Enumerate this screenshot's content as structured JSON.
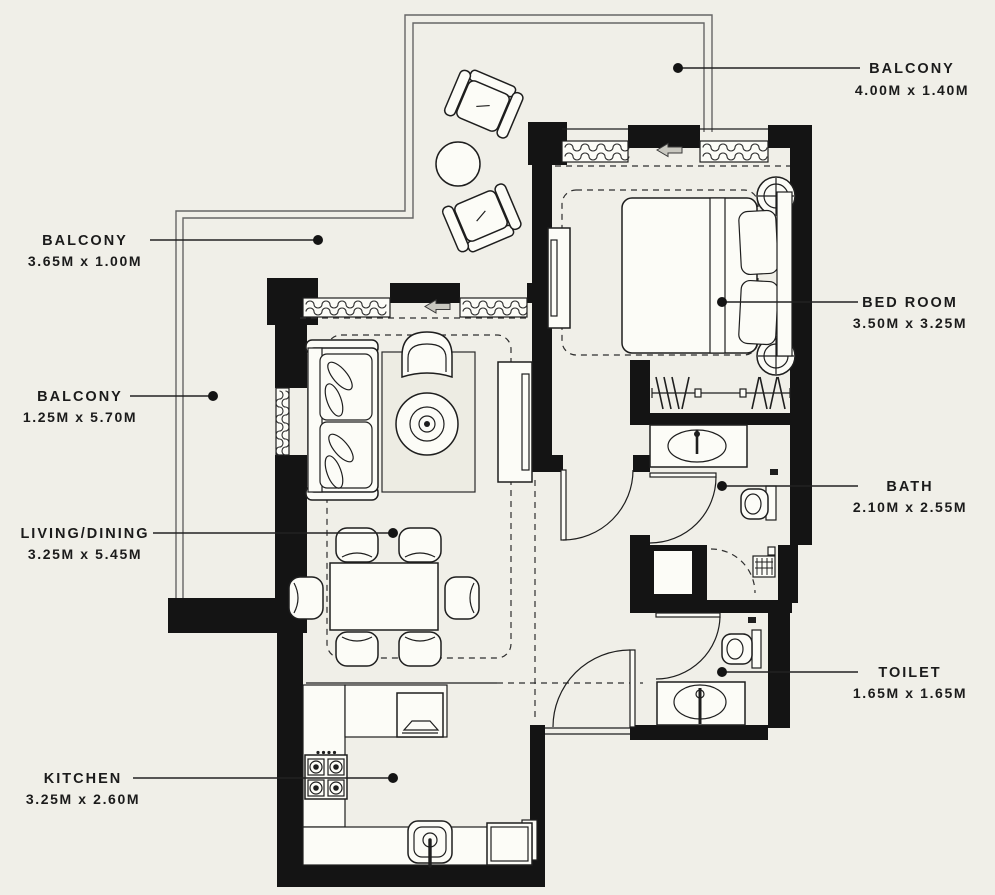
{
  "title": "apartment-floor-plan",
  "colors": {
    "background": "#f0efe8",
    "wall": "#141414",
    "line": "#2a2a2a",
    "fixture": "#fcfcf7"
  },
  "rooms": [
    {
      "id": "balcony-top",
      "name": "BALCONY",
      "dims": "4.00M x 1.40M"
    },
    {
      "id": "balcony-upper-left",
      "name": "BALCONY",
      "dims": "3.65M x 1.00M"
    },
    {
      "id": "balcony-left",
      "name": "BALCONY",
      "dims": "1.25M x 5.70M"
    },
    {
      "id": "living-dining",
      "name": "LIVING/DINING",
      "dims": "3.25M x 5.45M"
    },
    {
      "id": "kitchen",
      "name": "KITCHEN",
      "dims": "3.25M x 2.60M"
    },
    {
      "id": "bedroom",
      "name": "BED ROOM",
      "dims": "3.50M x 3.25M"
    },
    {
      "id": "bath",
      "name": "BATH",
      "dims": "2.10M x 2.55M"
    },
    {
      "id": "toilet",
      "name": "TOILET",
      "dims": "1.65M x 1.65M"
    }
  ]
}
